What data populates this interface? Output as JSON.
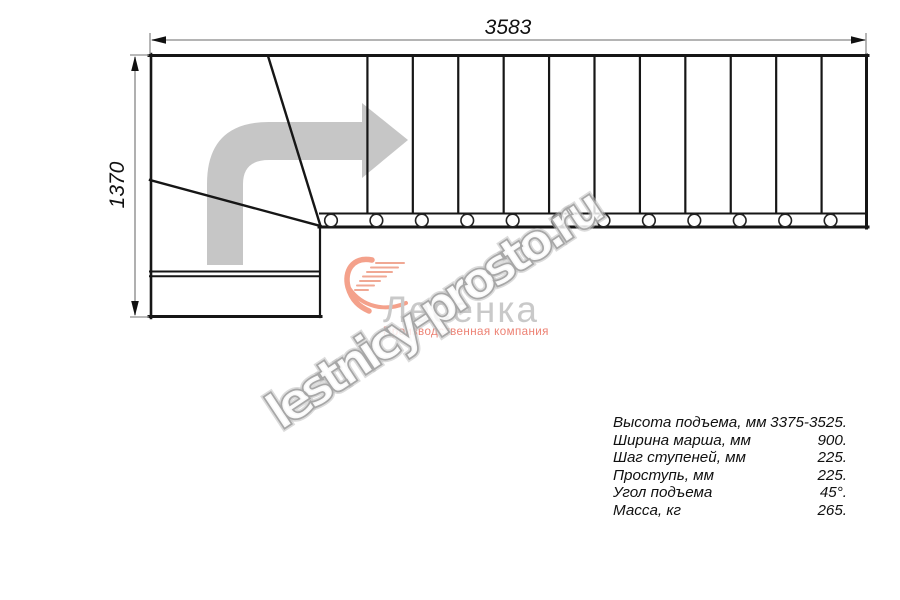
{
  "drawing": {
    "title": "stair-plan-top-view",
    "width_dim": "3583",
    "height_dim": "1370",
    "straight_tread_count": 12,
    "baluster_count": 12
  },
  "specs": {
    "rows": [
      {
        "label": "Высота подъема, мм",
        "value": "3375-3525."
      },
      {
        "label": "Ширина марша, мм",
        "value": "900."
      },
      {
        "label": "Шаг ступеней, мм",
        "value": "225."
      },
      {
        "label": "Проступь, мм",
        "value": "225."
      },
      {
        "label": "Угол подъема",
        "value": "45°."
      },
      {
        "label": "Масса, кг",
        "value": "265."
      }
    ]
  },
  "logo": {
    "name": "Лесенка",
    "subtitle": "Производственная компания"
  },
  "watermark": {
    "text": "lestnicy-prosto.ru"
  },
  "colors": {
    "line": "#161616",
    "dimension_line": "#9c9c9c",
    "direction_arrow": "#c6c6c6",
    "logo_accent": "#f4a18b",
    "logo_subtitle": "#ed8173",
    "logo_text": "#c9c9c9",
    "watermark_outline": "#a7a7a7"
  }
}
